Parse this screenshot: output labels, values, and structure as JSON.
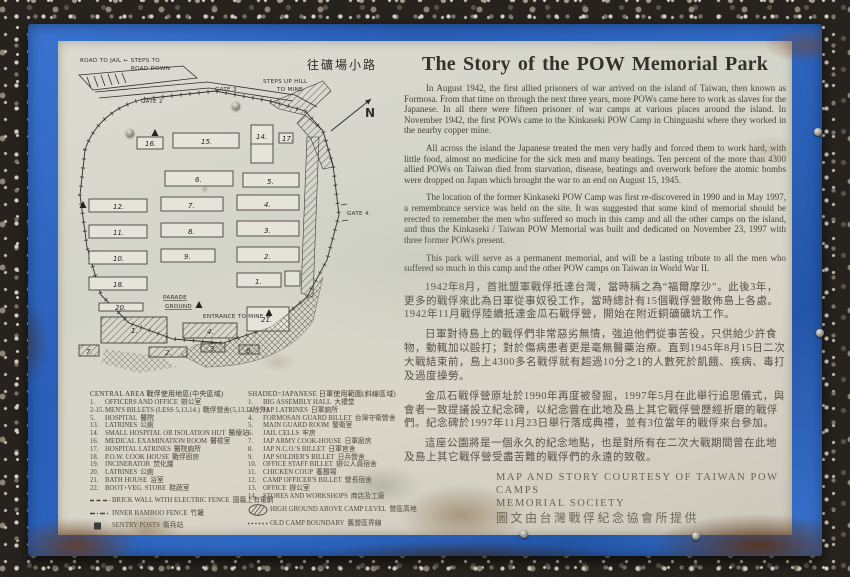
{
  "story": {
    "title": "The Story of the POW Memorial Park",
    "en": [
      "In August 1942, the first allied prisoners of war arrived on the island of Taiwan, then known as Formosa. From that time on through the next three years, more POWs came here to work as slaves for the Japanese. In all there were fifteen prisoner of war camps at various places around the island. In November 1942, the first POWs came to the Kinkaseki POW Camp in Chinguashi where they worked in the nearby copper mine.",
      "All across the island the Japanese treated the men very badly and forced them to work hard, with little food, almost no medicine for the sick men and many beatings. Ten percent of the more than 4300 allied POWs on Taiwan died from starvation, disease, beatings and overwork before the atomic bombs were dropped on Japan which brought the war to an end on August 15, 1945.",
      "The location of the former Kinkaseki POW Camp was first re-discovered in 1990 and in May 1997, a remembrance service was held on the site. It was suggested that some kind of memorial should be erected to remember the men who suffered so much in this camp and all the other camps on the island, and thus the Kinkaseki / Taiwan POW Memorial was built and dedicated on November 23, 1997 with three former POWs present.",
      "This park will serve as a permanent memorial, and will be a lasting tribute to all the men who suffered so much in this camp and the other POW camps on Taiwan in World War II."
    ],
    "zh": [
      "1942年8月，首批盟軍戰俘抵達台灣，當時稱之為“福爾摩沙”。此後3年，更多的戰俘來此為日軍從事奴役工作，當時總計有15個戰俘營散佈島上各處。1942年11月戰俘陸續抵達金瓜石戰俘營，開始在附近銅礦礦坑工作。",
      "日軍對待島上的戰俘們非常惡劣無情，強迫他們從事苦役，只供給少許食物，動輒加以毆打；對於傷病患者更是毫無醫藥治療。直到1945年8月15日二次大戰結束前，島上4300多名戰俘就有超過10分之1的人數死於飢餓、疾病、毒打及過度操勞。",
      "金瓜石戰俘營原址於1990年再度被發掘，1997年5月在此舉行追思儀式，與會者一致提議設立紀念碑，以紀念曾在此地及島上其它戰俘營歷經折磨的戰俘們。紀念碑於1997年11月23日舉行落成典禮，並有3位當年的戰俘來台參加。",
      "這座公園將是一個永久的紀念地點，也是對所有在二次大戰期間曾在此地及島上其它戰俘營受盡苦難的戰俘們的永遠的致敬。"
    ],
    "credit1": "MAP AND STORY COURTESY OF TAIWAN POW CAMPS",
    "credit2": "MEMORIAL SOCIETY",
    "credit_zh": "圖文由台灣戰俘紀念協會所提供"
  },
  "map": {
    "note1": "ROAD TO JAIL ← STEPS TO",
    "note2": "ROAD DOWN",
    "gate2": "GATE 2",
    "gate3": "GATE 3",
    "steps1": "STEPS UP HILL",
    "steps2": "TO MINE",
    "path_zh": "往礦場小路",
    "compass": "N",
    "parade1": "PARADE",
    "parade2": "GROUND",
    "entrance": "ENTRANCE TO MINE →",
    "gate4": "GATE 4.",
    "b": {
      "1": "1.",
      "2": "2.",
      "3": "3.",
      "4": "4.",
      "5": "5.",
      "6": "6.",
      "7": "7.",
      "8": "8.",
      "9": "9.",
      "10": "10.",
      "11": "11.",
      "12": "12.",
      "14": "14.",
      "15": "15.",
      "16": "16.",
      "17": "17.",
      "18": "18.",
      "20": "20.",
      "21": "21."
    },
    "s": {
      "1": "1.",
      "2": "2.",
      "3": "3.",
      "4": "4.",
      "6": "6.",
      "7": "7."
    }
  },
  "legend": {
    "central": {
      "header_en": "CENTRAL AREA",
      "header_zh": "戰俘使用地區(中央區域)",
      "items": [
        {
          "n": "1.",
          "en": "OFFICERS AND OFFICE",
          "zh": "辦公室"
        },
        {
          "n": "2-15.",
          "en": "MEN'S BILLETS (LESS 5,13,14.)",
          "zh": "戰俘營舍(5,13,14除外)"
        },
        {
          "n": "5.",
          "en": "HOSPITAL",
          "zh": "醫院"
        },
        {
          "n": "13.",
          "en": "LATRINES",
          "zh": "公廁"
        },
        {
          "n": "14.",
          "en": "SMALL HOSPITAL OR ISOLATION HUT",
          "zh": "醫療站"
        },
        {
          "n": "16.",
          "en": "MEDICAL EXAMINATION ROOM",
          "zh": "醫檢室"
        },
        {
          "n": "17.",
          "en": "HOSPITAL LATRINES",
          "zh": "醫院廁所"
        },
        {
          "n": "18.",
          "en": "P.O.W. COOK HOUSE",
          "zh": "戰俘廚房"
        },
        {
          "n": "19.",
          "en": "INCINERATOR",
          "zh": "焚化爐"
        },
        {
          "n": "20.",
          "en": "LATRINES",
          "zh": "公廁"
        },
        {
          "n": "21.",
          "en": "BATH HOUSE",
          "zh": "浴室"
        },
        {
          "n": "22.",
          "en": "BOOT+VEG. STORE",
          "zh": "鞋蔬室"
        }
      ],
      "symbols": [
        {
          "en": "BRICK WALL WITH ELECTRIC FENCE",
          "zh": "圍牆上有電網"
        },
        {
          "en": "INNER BAMBOO FENCE",
          "zh": "竹籬"
        },
        {
          "en": "SENTRY POSTS",
          "zh": "衛兵站"
        }
      ]
    },
    "shaded": {
      "header_en": "SHADED=JAPANESE",
      "header_zh": "日軍使用範圍(斜線區域)",
      "items": [
        {
          "n": "1.",
          "en": "BIG ASSEMBLY HALL",
          "zh": "大禮堂"
        },
        {
          "n": "2.",
          "en": "JAP LATRINES",
          "zh": "日軍廁所"
        },
        {
          "n": "4.",
          "en": "FORMOSAN GUARD BILLET",
          "zh": "台灣守衛營舍"
        },
        {
          "n": "5.",
          "en": "MAIN GUARD ROOM",
          "zh": "警衛室"
        },
        {
          "n": "6.",
          "en": "JAIL CELLS",
          "zh": "牢房"
        },
        {
          "n": "7.",
          "en": "JAP ARMY COOK-HOUSE",
          "zh": "日軍廚房"
        },
        {
          "n": "8.",
          "en": "JAP N.C.O.'S BILLET",
          "zh": "日軍官舍"
        },
        {
          "n": "9.",
          "en": "JAP SOLDIER'S BILLET",
          "zh": "日兵營舍"
        },
        {
          "n": "10.",
          "en": "OFFICE STAFF BILLET",
          "zh": "辦公人員宿舍"
        },
        {
          "n": "11.",
          "en": "CHICKEN COUP",
          "zh": "養雞場"
        },
        {
          "n": "12.",
          "en": "CAMP OFFICER'S BILLET",
          "zh": "營長宿舍"
        },
        {
          "n": "13.",
          "en": "OFFICE",
          "zh": "辦公室"
        },
        {
          "n": "14.",
          "en": "STORES AND WORKSHOPS",
          "zh": "商店及工廠"
        }
      ],
      "symbols": [
        {
          "en": "HIGH GROUND ABOVE CAMP LEVEL",
          "zh": "營區高地"
        },
        {
          "en": "OLD CAMP BOUNDARY",
          "zh": "舊營區界線"
        }
      ]
    }
  }
}
